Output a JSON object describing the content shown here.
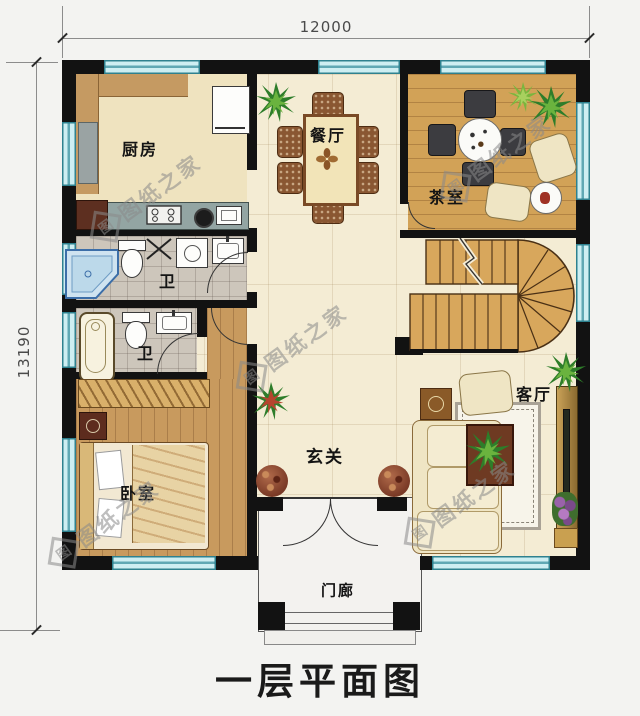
{
  "title": "一层平面图",
  "dimensions": {
    "top": "12000",
    "left": "13190"
  },
  "watermark": {
    "text": "图纸之家",
    "logo_char": "图"
  },
  "rooms": {
    "kitchen": "厨房",
    "dining": "餐厅",
    "tea_room": "茶室",
    "bath_upper": "卫",
    "bath_lower": "卫",
    "bedroom": "卧室",
    "entry_hall": "玄关",
    "living_room": "客厅",
    "porch": "门廊"
  },
  "colors": {
    "wall": "#121212",
    "window_glass": "#cdeef2",
    "window_frame": "#2e818f",
    "cream_floor": "#f4ecd4",
    "wood_floor": "#c89a5e",
    "tea_floor": "#d2a257",
    "tile_floor": "#cdc6bb",
    "stairs": "#d8a75c",
    "watermark": "#8a8a8a"
  }
}
